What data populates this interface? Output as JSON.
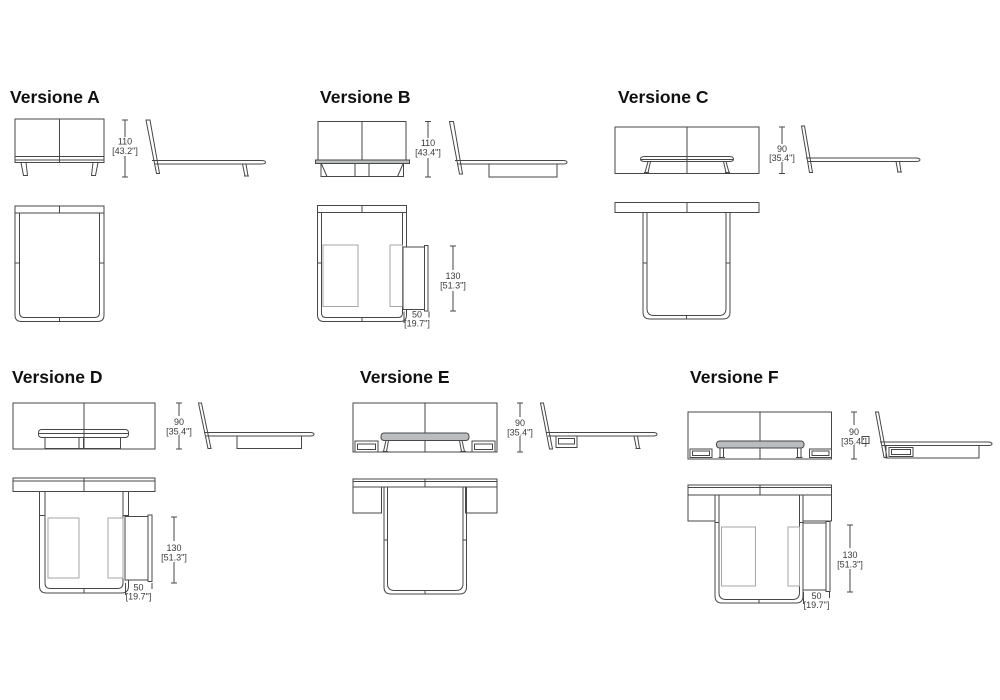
{
  "page": {
    "background": "#ffffff"
  },
  "colors": {
    "line": "#474747",
    "title_text": "#111111",
    "dim_text": "#3a3a3a",
    "bench_fill": "#b9bdbd"
  },
  "versions": [
    {
      "id": "A",
      "title": "Versione A",
      "dims": {
        "height": {
          "cm": "110",
          "inch": "[43.2\"]"
        }
      }
    },
    {
      "id": "B",
      "title": "Versione B",
      "dims": {
        "height": {
          "cm": "110",
          "inch": "[43.4\"]"
        },
        "length": {
          "cm": "130",
          "inch": "[51.3\"]"
        },
        "depth": {
          "cm": "50",
          "inch": "[19.7\"]"
        }
      }
    },
    {
      "id": "C",
      "title": "Versione C",
      "dims": {
        "height": {
          "cm": "90",
          "inch": "[35.4\"]"
        }
      }
    },
    {
      "id": "D",
      "title": "Versione D",
      "dims": {
        "height": {
          "cm": "90",
          "inch": "[35.4\"]"
        },
        "length": {
          "cm": "130",
          "inch": "[51.3\"]"
        },
        "depth": {
          "cm": "50",
          "inch": "[19.7\"]"
        }
      }
    },
    {
      "id": "E",
      "title": "Versione E",
      "dims": {
        "height": {
          "cm": "90",
          "inch": "[35.4\"]"
        }
      }
    },
    {
      "id": "F",
      "title": "Versione F",
      "dims": {
        "height": {
          "cm": "90",
          "inch": "[35.4\"]"
        },
        "length": {
          "cm": "130",
          "inch": "[51.3\"]"
        },
        "depth": {
          "cm": "50",
          "inch": "[19.7\"]"
        }
      }
    }
  ]
}
